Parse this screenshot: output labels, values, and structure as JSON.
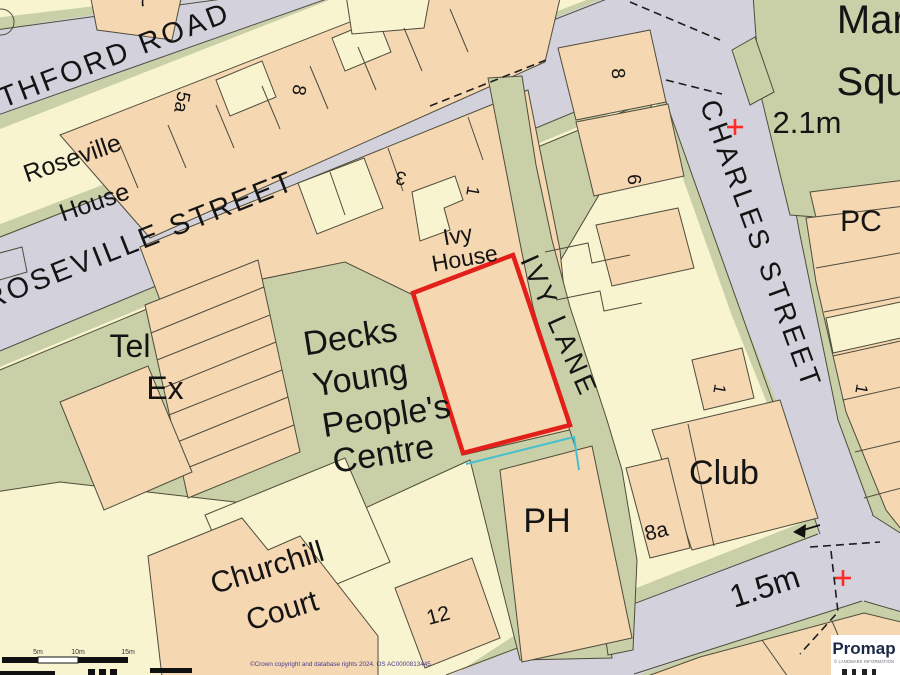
{
  "map": {
    "streets": {
      "thford_road": "THFORD ROAD",
      "roseville_street": "ROSEVILLE STREET",
      "charles_street": "CHARLES STREET",
      "ivy_lane": "IVY LANE"
    },
    "labels": {
      "roseville_house_1": "Roseville",
      "roseville_house_2": "House",
      "tel": "Tel",
      "ex": "Ex",
      "decks_1": "Decks",
      "decks_2": "Young",
      "decks_3": "People's",
      "decks_4": "Centre",
      "ivy_house_1": "Ivy",
      "ivy_house_2": "House",
      "churchill_1": "Churchill",
      "churchill_2": "Court",
      "market_1": "Market",
      "market_2": "Square",
      "ph": "PH",
      "club": "Club",
      "pc": "PC"
    },
    "numbers": {
      "n7": "7",
      "n5a": "5a",
      "n8_nw": "8",
      "n3": "3",
      "n1_ivy": "1",
      "n8_charles": "8",
      "n6_charles": "6",
      "n1_block": "1",
      "n1_east": "1",
      "n8a": "8a",
      "n12": "12"
    },
    "spot_heights": {
      "h1": "2.1m",
      "h2": "1.5m"
    },
    "scale_bar": {
      "t1": "5m",
      "t2": "10m",
      "t3": "15m"
    },
    "copyright": "©Crown copyright and database rights 2024. OS AC0000813445",
    "promap": {
      "brand": "Promap",
      "subtitle": "© LANDMARK INFORMATION"
    },
    "colors": {
      "building_peach": "#f5d7b2",
      "road_grey": "#d3d2dc",
      "green": "#c9cfa6",
      "cream": "#f8f4d0",
      "outline": "#4f4c3c",
      "plot_red": "#e31f1a",
      "cyan_line": "#45c0d0",
      "cross_red": "#ff2b24"
    }
  }
}
